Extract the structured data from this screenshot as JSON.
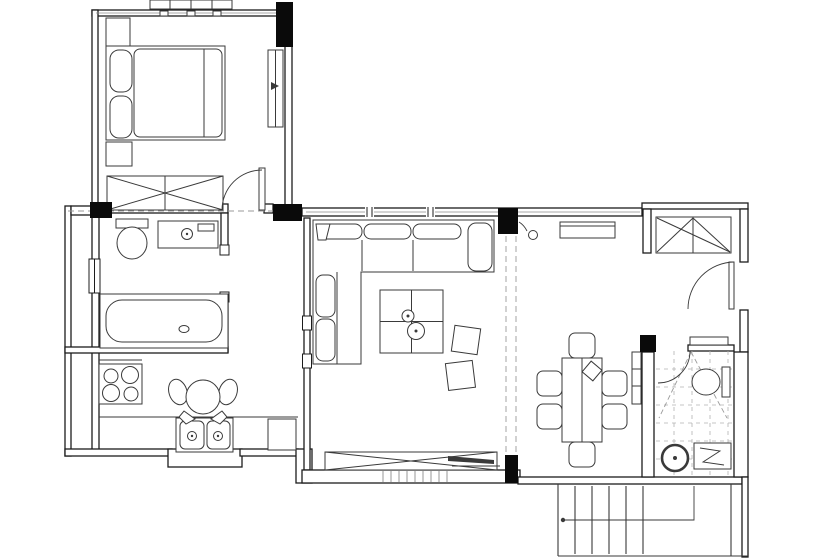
{
  "canvas": {
    "viewBox": "0 0 820 560",
    "width": "820",
    "height": "560",
    "bg": "#ffffff"
  },
  "colors": {
    "wall": "#1c1c1c",
    "column": "#0a0a0a",
    "furniture": "#3a3a3a",
    "light": "#8c8c8c",
    "dash": "#9a9a9a",
    "tile": "#b3b3b3"
  },
  "plan": {
    "type": "apartment-floor-plan",
    "rooms": [
      {
        "name": "bedroom",
        "furniture": [
          "double-bed",
          "two-pillows",
          "nightstand-top",
          "nightstand-bottom",
          "tall-cabinet",
          "crossed-wardrobe",
          "exterior-dresser",
          "swing-door"
        ]
      },
      {
        "name": "bathroom",
        "furniture": [
          "toilet",
          "vanity-with-basin",
          "bathtub",
          "window",
          "pocket-door-opening"
        ]
      },
      {
        "name": "kitchen",
        "furniture": [
          "cooktop",
          "round-table-with-chairs",
          "double-sink",
          "counter",
          "appliance",
          "sink-bay-window"
        ]
      },
      {
        "name": "living-room",
        "furniture": [
          "l-shaped-sofa",
          "coffee-table",
          "pouf",
          "pouf",
          "tv-sideboard",
          "window-band"
        ]
      },
      {
        "name": "dining-room",
        "furniture": [
          "dining-table",
          "dining-chairs",
          "sideboard",
          "wall-console",
          "ceiling-beam-dashed"
        ]
      },
      {
        "name": "entry",
        "furniture": [
          "closet-wardrobe",
          "entry-swing-door"
        ]
      },
      {
        "name": "wc",
        "furniture": [
          "toilet",
          "round-washbasin",
          "shower-with-drain-zigzag",
          "tile-grid",
          "swing-door"
        ]
      },
      {
        "name": "staircase",
        "furniture": [
          "steps",
          "direction-line-with-dot"
        ]
      }
    ],
    "counts": {
      "cooktop_burners": 4,
      "dining_chairs": 6,
      "stair_steps": 5,
      "structural_columns": 6,
      "sofa_back_cushions": 3
    }
  }
}
